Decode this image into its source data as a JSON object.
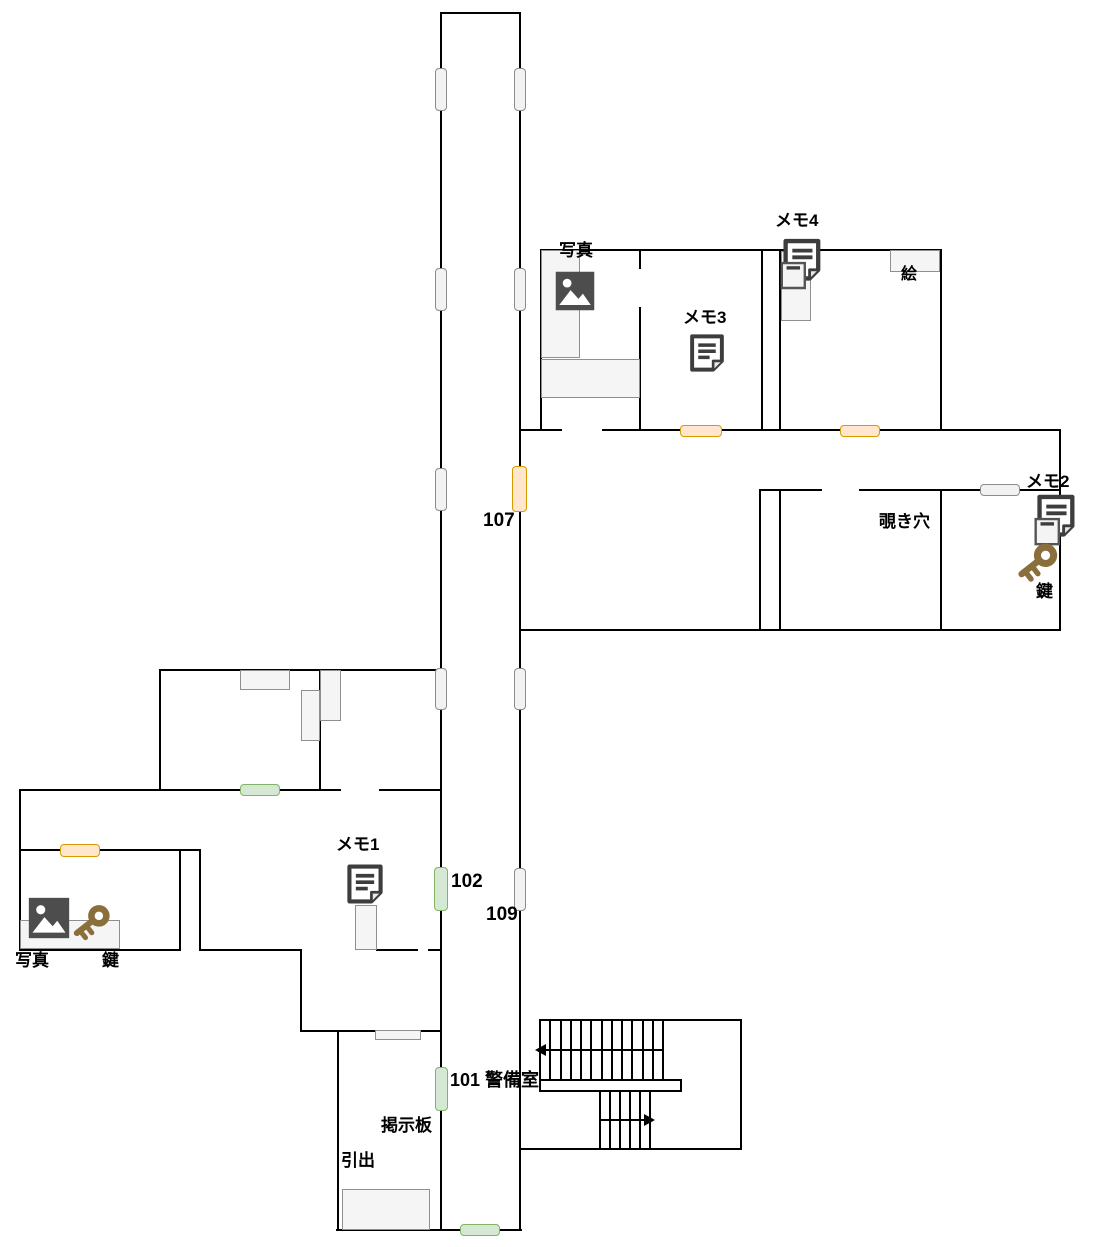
{
  "title": "floor-plan-map",
  "colors": {
    "wall": "#000000",
    "door_gray_fill": "#f2f2f2",
    "door_gray_stroke": "#8c8c8c",
    "door_orange_fill": "#ffe6cc",
    "door_orange_stroke": "#d79b00",
    "door_green_fill": "#d5e8d4",
    "door_green_stroke": "#82b366",
    "furniture_fill": "#f5f5f5",
    "furniture_stroke": "#8f8f8f",
    "image_icon": "#4d4d4d",
    "note_icon": "#3d3d3d",
    "key_icon": "#8a6f3d",
    "label": "#000000",
    "background": "#ffffff"
  },
  "walls": [
    [
      440,
      12,
      2,
      1219
    ],
    [
      519,
      12,
      2,
      1219
    ],
    [
      440,
      12,
      81,
      2
    ],
    [
      336,
      1229,
      186,
      2
    ],
    [
      540,
      249,
      402,
      2
    ],
    [
      540,
      249,
      2,
      182
    ],
    [
      639,
      249,
      2,
      20
    ],
    [
      639,
      307,
      2,
      124
    ],
    [
      761,
      249,
      2,
      182
    ],
    [
      779,
      249,
      2,
      182
    ],
    [
      940,
      249,
      2,
      182
    ],
    [
      519,
      429,
      43,
      2
    ],
    [
      602,
      429,
      459,
      2
    ],
    [
      759,
      489,
      63,
      2
    ],
    [
      859,
      489,
      202,
      2
    ],
    [
      759,
      489,
      2,
      142
    ],
    [
      779,
      489,
      2,
      142
    ],
    [
      940,
      489,
      2,
      142
    ],
    [
      1059,
      429,
      2,
      202
    ],
    [
      519,
      629,
      542,
      2
    ],
    [
      159,
      669,
      283,
      2
    ],
    [
      159,
      669,
      2,
      122
    ],
    [
      319,
      669,
      2,
      122
    ],
    [
      19,
      789,
      322,
      2
    ],
    [
      379,
      789,
      63,
      2
    ],
    [
      19,
      789,
      2,
      162
    ],
    [
      19,
      849,
      182,
      2
    ],
    [
      179,
      849,
      2,
      102
    ],
    [
      199,
      849,
      2,
      102
    ],
    [
      19,
      949,
      162,
      2
    ],
    [
      199,
      949,
      103,
      2
    ],
    [
      376,
      949,
      42,
      2
    ],
    [
      428,
      949,
      14,
      2
    ],
    [
      300,
      949,
      2,
      83
    ],
    [
      300,
      1030,
      142,
      2
    ],
    [
      337,
      1030,
      2,
      201
    ],
    [
      539,
      1019,
      203,
      2
    ],
    [
      740,
      1019,
      2,
      131
    ],
    [
      520,
      1148,
      222,
      2
    ]
  ],
  "furniture": [
    [
      541,
      250,
      39,
      108
    ],
    [
      541,
      359,
      99,
      39
    ],
    [
      781,
      251,
      30,
      70
    ],
    [
      890,
      250,
      50,
      22
    ],
    [
      240,
      670,
      50,
      20
    ],
    [
      301,
      690,
      19,
      51
    ],
    [
      320,
      670,
      21,
      51
    ],
    [
      20,
      920,
      100,
      29
    ],
    [
      355,
      905,
      22,
      45
    ],
    [
      375,
      1030,
      46,
      10
    ],
    [
      342,
      1189,
      88,
      41
    ]
  ],
  "doors": [
    {
      "x": 435,
      "y": 68,
      "w": 12,
      "h": 43,
      "color": "gray",
      "name": "door-corridor-west-1"
    },
    {
      "x": 514,
      "y": 68,
      "w": 12,
      "h": 43,
      "color": "gray",
      "name": "door-corridor-east-1"
    },
    {
      "x": 435,
      "y": 268,
      "w": 12,
      "h": 43,
      "color": "gray",
      "name": "door-corridor-west-2"
    },
    {
      "x": 514,
      "y": 268,
      "w": 12,
      "h": 43,
      "color": "gray",
      "name": "door-corridor-east-2"
    },
    {
      "x": 435,
      "y": 468,
      "w": 12,
      "h": 43,
      "color": "gray",
      "name": "door-corridor-west-3"
    },
    {
      "x": 512,
      "y": 466,
      "w": 15,
      "h": 46,
      "color": "orange",
      "name": "door-107"
    },
    {
      "x": 435,
      "y": 668,
      "w": 12,
      "h": 42,
      "color": "gray",
      "name": "door-corridor-west-4"
    },
    {
      "x": 514,
      "y": 668,
      "w": 12,
      "h": 42,
      "color": "gray",
      "name": "door-corridor-east-4"
    },
    {
      "x": 434,
      "y": 867,
      "w": 14,
      "h": 44,
      "color": "green",
      "name": "door-102"
    },
    {
      "x": 514,
      "y": 868,
      "w": 12,
      "h": 43,
      "color": "gray",
      "name": "door-109"
    },
    {
      "x": 435,
      "y": 1067,
      "w": 13,
      "h": 44,
      "color": "green",
      "name": "door-101"
    },
    {
      "x": 460,
      "y": 1224,
      "w": 40,
      "h": 12,
      "color": "green",
      "name": "door-south-exit"
    },
    {
      "x": 240,
      "y": 784,
      "w": 40,
      "h": 12,
      "color": "green",
      "name": "door-west-room"
    },
    {
      "x": 60,
      "y": 844,
      "w": 40,
      "h": 13,
      "color": "orange",
      "name": "door-southwest-room"
    },
    {
      "x": 680,
      "y": 425,
      "w": 42,
      "h": 12,
      "color": "orange",
      "name": "door-north-room-1"
    },
    {
      "x": 840,
      "y": 425,
      "w": 40,
      "h": 12,
      "color": "orange",
      "name": "door-north-room-2"
    },
    {
      "x": 980,
      "y": 484,
      "w": 40,
      "h": 12,
      "color": "gray",
      "name": "door-memo2-room"
    }
  ],
  "labels": [
    {
      "text": "写真",
      "x": 559,
      "y": 242,
      "size": 17,
      "name": "photo-label-top"
    },
    {
      "text": "メモ3",
      "x": 683,
      "y": 309,
      "size": 17,
      "name": "memo3-label"
    },
    {
      "text": "メモ4",
      "x": 775,
      "y": 212,
      "size": 17,
      "name": "memo4-label"
    },
    {
      "text": "絵",
      "x": 901,
      "y": 266,
      "size": 16,
      "name": "picture-label"
    },
    {
      "text": "メモ2",
      "x": 1026,
      "y": 473,
      "size": 17,
      "name": "memo2-label"
    },
    {
      "text": "覗き穴",
      "x": 879,
      "y": 513,
      "size": 17,
      "name": "peephole-label"
    },
    {
      "text": "鍵",
      "x": 1036,
      "y": 583,
      "size": 17,
      "name": "key-label-right"
    },
    {
      "text": "107",
      "x": 483,
      "y": 511,
      "size": 19,
      "name": "room-107-label"
    },
    {
      "text": "メモ1",
      "x": 336,
      "y": 836,
      "size": 17,
      "name": "memo1-label"
    },
    {
      "text": "102",
      "x": 451,
      "y": 872,
      "size": 19,
      "name": "room-102-label"
    },
    {
      "text": "109",
      "x": 486,
      "y": 905,
      "size": 19,
      "name": "room-109-label"
    },
    {
      "text": "写真",
      "x": 15,
      "y": 952,
      "size": 17,
      "name": "photo-label-left"
    },
    {
      "text": "鍵",
      "x": 102,
      "y": 952,
      "size": 17,
      "name": "key-label-left"
    },
    {
      "text": "101 警備室",
      "x": 450,
      "y": 1071,
      "size": 18,
      "name": "room-101-security-label"
    },
    {
      "text": "掲示板",
      "x": 381,
      "y": 1117,
      "size": 17,
      "name": "bulletin-board-label"
    },
    {
      "text": "引出",
      "x": 341,
      "y": 1152,
      "size": 17,
      "name": "drawer-label"
    }
  ],
  "icons": [
    {
      "type": "image",
      "x": 554,
      "y": 270,
      "w": 42,
      "h": 42,
      "name": "photo-image-icon-top"
    },
    {
      "type": "note",
      "x": 686,
      "y": 329,
      "w": 42,
      "h": 48,
      "name": "memo3-note-icon"
    },
    {
      "type": "note2",
      "x": 777,
      "y": 236,
      "w": 46,
      "h": 58,
      "name": "memo4-note-icon"
    },
    {
      "type": "note2",
      "x": 1029,
      "y": 494,
      "w": 50,
      "h": 54,
      "name": "memo2-note-icon"
    },
    {
      "type": "note",
      "x": 343,
      "y": 860,
      "w": 44,
      "h": 48,
      "name": "memo1-note-icon"
    },
    {
      "type": "image",
      "x": 26,
      "y": 896,
      "w": 46,
      "h": 44,
      "name": "photo-image-icon-left"
    },
    {
      "type": "key",
      "x": 66,
      "y": 898,
      "w": 50,
      "h": 48,
      "name": "key-icon-left"
    },
    {
      "type": "key",
      "x": 1010,
      "y": 536,
      "w": 54,
      "h": 52,
      "name": "key-icon-right"
    }
  ],
  "stairs": {
    "upper_flight": {
      "x_start": 540,
      "x_end": 663,
      "lines": 13,
      "y_top": 1021,
      "y_bottom": 1079
    },
    "landing": {
      "x": 539,
      "y": 1079,
      "w": 143,
      "h": 13
    },
    "lower_flight": {
      "x_start": 600,
      "x_end": 650,
      "lines": 6,
      "y_top": 1092,
      "y_bottom": 1148
    },
    "arrows": [
      {
        "x1": 546,
        "x2": 663,
        "y": 1049,
        "dir": "left"
      },
      {
        "x1": 600,
        "x2": 644,
        "y": 1119,
        "dir": "right"
      }
    ]
  }
}
